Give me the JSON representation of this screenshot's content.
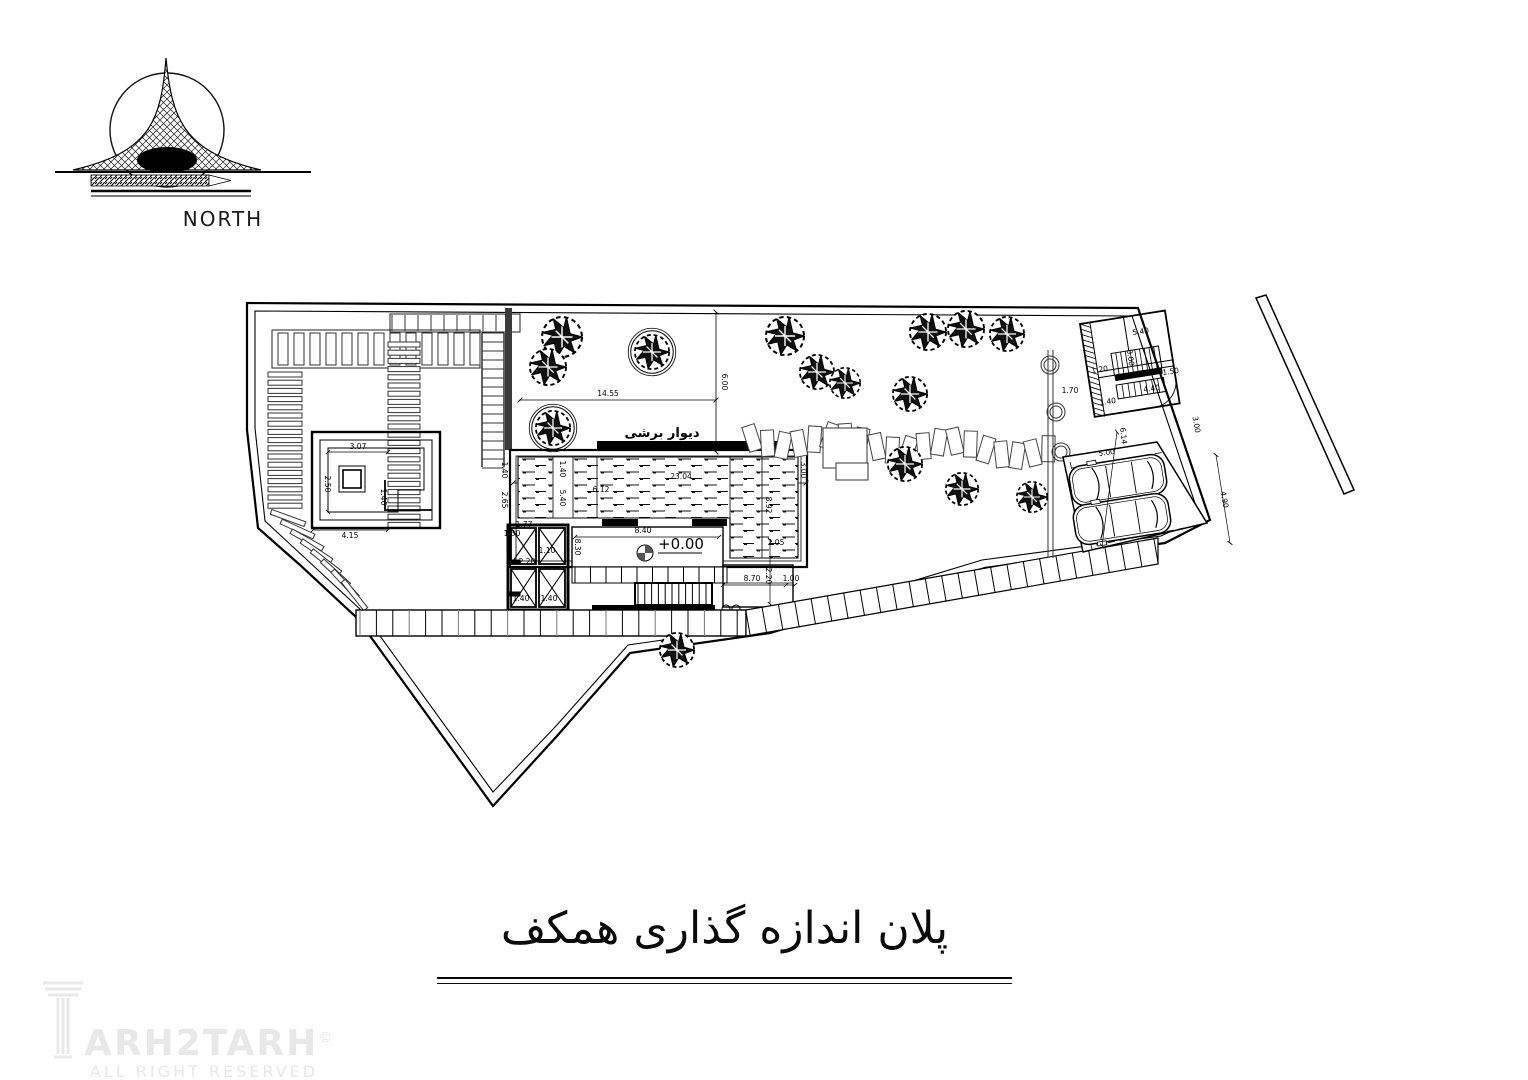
{
  "north": {
    "label": "NORTH"
  },
  "title": {
    "text": "پلان اندازه گذاری همکف"
  },
  "watermark": {
    "brand_text": "ARH2TARH",
    "copyright": "©",
    "tagline": "ALL RIGHT RESERVED"
  },
  "plan": {
    "labels": {
      "shear_wall_top": "دیوار برشی",
      "shear_wall_bottom": "دیوار برشی",
      "level_datum": "+0.00"
    },
    "colors": {
      "ink": "#000000",
      "gray": "#777777",
      "watermark": "#e8e8e8"
    },
    "dimensions": [
      {
        "text": "14.55",
        "x": 608,
        "y": 396,
        "rot": 0
      },
      {
        "text": "6.00",
        "x": 722,
        "y": 382,
        "rot": 90
      },
      {
        "text": "23.04",
        "x": 681,
        "y": 479,
        "rot": 0
      },
      {
        "text": "1.40",
        "x": 560,
        "y": 469,
        "rot": 90
      },
      {
        "text": "5.40",
        "x": 560,
        "y": 498,
        "rot": 90
      },
      {
        "text": "6.12",
        "x": 601,
        "y": 492,
        "rot": 0
      },
      {
        "text": "3.00",
        "x": 801,
        "y": 470,
        "rot": 90
      },
      {
        "text": "8.92",
        "x": 766,
        "y": 505,
        "rot": 90
      },
      {
        "text": "2.05",
        "x": 776,
        "y": 545,
        "rot": 0
      },
      {
        "text": "1.40",
        "x": 502,
        "y": 470,
        "rot": 90
      },
      {
        "text": "2.65",
        "x": 502,
        "y": 500,
        "rot": 90
      },
      {
        "text": "8.40",
        "x": 643,
        "y": 533,
        "rot": 0
      },
      {
        "text": "8.70",
        "x": 752,
        "y": 581,
        "rot": 0
      },
      {
        "text": "1.00",
        "x": 791,
        "y": 581,
        "rot": 0
      },
      {
        "text": "2.20",
        "x": 766,
        "y": 576,
        "rot": 90
      },
      {
        "text": "1.77",
        "x": 524,
        "y": 527,
        "rot": 0
      },
      {
        "text": "1.30",
        "x": 512,
        "y": 536,
        "rot": 0
      },
      {
        "text": "1.10",
        "x": 547,
        "y": 553,
        "rot": 0
      },
      {
        "text": "2.20",
        "x": 527,
        "y": 564,
        "rot": 0
      },
      {
        "text": "1.40",
        "x": 521,
        "y": 601,
        "rot": 0
      },
      {
        "text": "1.40",
        "x": 549,
        "y": 601,
        "rot": 0
      },
      {
        "text": "8.30",
        "x": 575,
        "y": 547,
        "rot": 90
      },
      {
        "text": "3.07",
        "x": 358,
        "y": 449,
        "rot": 0
      },
      {
        "text": "2.50",
        "x": 325,
        "y": 484,
        "rot": 90
      },
      {
        "text": "1.46",
        "x": 381,
        "y": 497,
        "rot": 90
      },
      {
        "text": "4.15",
        "x": 350,
        "y": 538,
        "rot": 0
      },
      {
        "text": "6.14",
        "x": 1121,
        "y": 436,
        "rot": 84
      },
      {
        "text": "5.00",
        "x": 1107,
        "y": 455,
        "rot": -9
      },
      {
        "text": "4.90",
        "x": 1222,
        "y": 500,
        "rot": 80
      },
      {
        "text": "3.00",
        "x": 1194,
        "y": 425,
        "rot": 80
      },
      {
        "text": "5.40",
        "x": 1141,
        "y": 334,
        "rot": -8
      },
      {
        "text": "8.00",
        "x": 1128,
        "y": 358,
        "rot": 82
      },
      {
        "text": "1.50",
        "x": 1171,
        "y": 374,
        "rot": -8
      },
      {
        "text": "4.40",
        "x": 1152,
        "y": 391,
        "rot": -8
      },
      {
        "text": "1.40",
        "x": 1108,
        "y": 404,
        "rot": -8
      },
      {
        "text": "1.20",
        "x": 1100,
        "y": 372,
        "rot": -8
      },
      {
        "text": "1.70",
        "x": 1070,
        "y": 393,
        "rot": 0
      }
    ],
    "trees": [
      {
        "x": 562,
        "y": 337,
        "r": 21,
        "style": "filled"
      },
      {
        "x": 548,
        "y": 367,
        "r": 19,
        "style": "filled"
      },
      {
        "x": 553,
        "y": 428,
        "r": 18,
        "style": "circled"
      },
      {
        "x": 652,
        "y": 352,
        "r": 18,
        "style": "circled"
      },
      {
        "x": 785,
        "y": 336,
        "r": 20,
        "style": "filled"
      },
      {
        "x": 817,
        "y": 372,
        "r": 18,
        "style": "filled"
      },
      {
        "x": 845,
        "y": 383,
        "r": 16,
        "style": "filled"
      },
      {
        "x": 928,
        "y": 332,
        "r": 19,
        "style": "filled"
      },
      {
        "x": 966,
        "y": 329,
        "r": 19,
        "style": "filled"
      },
      {
        "x": 1007,
        "y": 334,
        "r": 18,
        "style": "filled"
      },
      {
        "x": 910,
        "y": 394,
        "r": 18,
        "style": "filled"
      },
      {
        "x": 905,
        "y": 464,
        "r": 18,
        "style": "filled"
      },
      {
        "x": 962,
        "y": 489,
        "r": 17,
        "style": "filled"
      },
      {
        "x": 1032,
        "y": 497,
        "r": 16,
        "style": "filled"
      },
      {
        "x": 677,
        "y": 650,
        "r": 18,
        "style": "filled"
      }
    ]
  }
}
